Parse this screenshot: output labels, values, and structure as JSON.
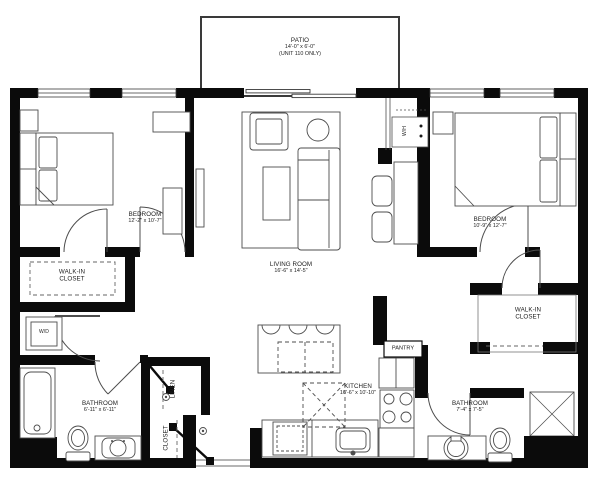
{
  "colors": {
    "wall": "#0b0b0b",
    "line": "#4d4d4d",
    "dash": "#666666",
    "background": "#ffffff",
    "text": "#1c1c1c"
  },
  "rooms": {
    "patio": {
      "name": "PATIO",
      "dims": "14'-0\" x 6'-0\"",
      "note": "(UNIT 110 ONLY)"
    },
    "bedroom_left": {
      "name": "BEDROOM",
      "dims": "12'-2\" x 10'-7\""
    },
    "living_room": {
      "name": "LIVING ROOM",
      "dims": "16'-6\" x 14'-5\""
    },
    "bedroom_right": {
      "name": "BEDROOM",
      "dims": "10'-9\" x 12'-7\""
    },
    "walk_in_closet_left": {
      "name": "WALK-IN CLOSET"
    },
    "walk_in_closet_right": {
      "name": "WALK-IN CLOSET"
    },
    "washer_dryer": {
      "name": "W/D"
    },
    "water_heater": {
      "name": "W/H"
    },
    "bathroom_left": {
      "name": "BATHROOM",
      "dims": "6'-11\" x 6'-11\""
    },
    "bathroom_right": {
      "name": "BATHROOM",
      "dims": "7'-4\" x 7'-5\""
    },
    "linen": {
      "name": "LINEN"
    },
    "closet": {
      "name": "CLOSET"
    },
    "kitchen": {
      "name": "KITCHEN",
      "dims": "16'-6\" x 10'-10\""
    },
    "pantry": {
      "name": "PANTRY"
    }
  }
}
